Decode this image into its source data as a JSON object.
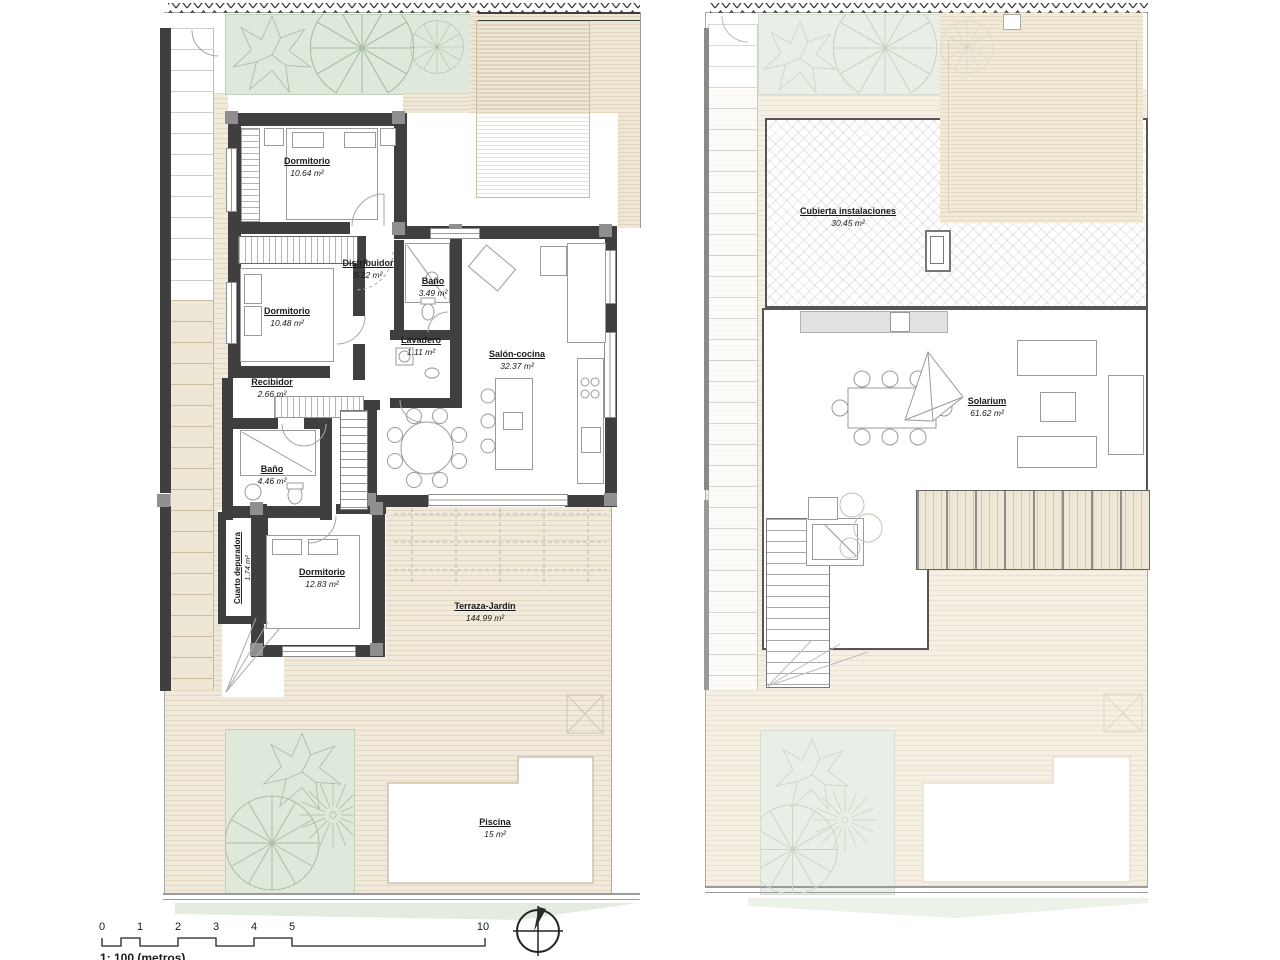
{
  "document": {
    "type": "architectural-floor-plan",
    "sheet": "two-level villa plan"
  },
  "plans": {
    "ground_floor": {
      "rooms": [
        {
          "label": "Dormitorio",
          "area": "10.64 m²"
        },
        {
          "label": "Distribuidor",
          "area": "5.22 m²"
        },
        {
          "label": "Baño",
          "area": "3.49 m²"
        },
        {
          "label": "Dormitorio",
          "area": "10.48 m²"
        },
        {
          "label": "Lavadero",
          "area": "1.11 m²"
        },
        {
          "label": "Salón-cocina",
          "area": "32.37 m²"
        },
        {
          "label": "Recibidor",
          "area": "2.66 m²"
        },
        {
          "label": "Baño",
          "area": "4.46 m²"
        },
        {
          "label": "Cuarto depuradora",
          "area": "1.74 m²"
        },
        {
          "label": "Dormitorio",
          "area": "12.83 m²"
        },
        {
          "label": "Terraza-Jardín",
          "area": "144.99 m²"
        },
        {
          "label": "Piscina",
          "area": "15 m²"
        }
      ]
    },
    "roof": {
      "rooms": [
        {
          "label": "Cubierta instalaciones",
          "area": "30.45 m²"
        },
        {
          "label": "Solarium",
          "area": "61.62 m²"
        }
      ]
    }
  },
  "scale_bar": {
    "ticks": [
      "0",
      "1",
      "2",
      "3",
      "4",
      "5",
      "10"
    ],
    "caption": "1: 100 (metros)"
  },
  "colors": {
    "wall": "#3f3f3f",
    "garden": "#dfe9db",
    "deck": "#efe7d6",
    "terrace": "#f1eadb",
    "faded_garden": "#e9efe6",
    "faded_terrace": "#f6f0e4"
  }
}
